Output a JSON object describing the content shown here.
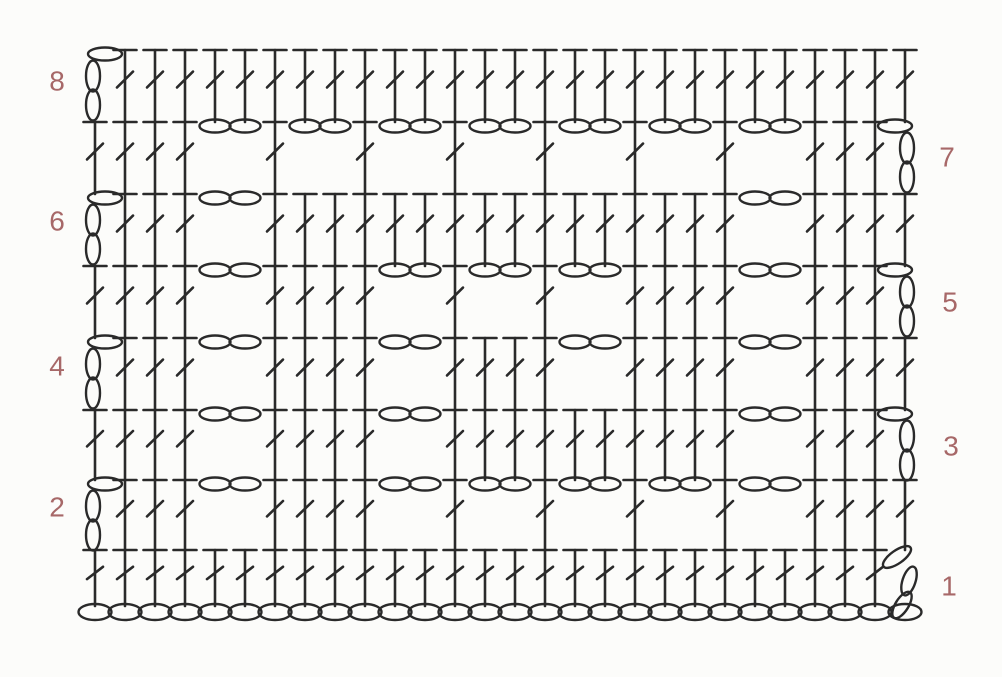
{
  "diagram": {
    "type": "crochet-symbol-chart",
    "background": "#fcfcfa",
    "stitch_color": "#2a2a2a",
    "label_color": "#a76868",
    "columns": 28,
    "geometry": {
      "col_start_x": 95,
      "col_pitch": 30,
      "foundation_y": 612,
      "canvas_w": 1002,
      "canvas_h": 677
    },
    "symbols": {
      "d": "double-crochet",
      "c": "chain",
      "t": "turning-chain-3"
    },
    "foundation": {
      "stitch": "chain",
      "count": 28
    },
    "rows": [
      {
        "number": 1,
        "label": "1",
        "label_side": "right",
        "label_x": 949,
        "label_y": 588,
        "top_y": 550,
        "base_y": 606,
        "turning_chain": {
          "side": "right",
          "style": "tilted"
        },
        "stitches": "dddddddddddddddddddddddddddt"
      },
      {
        "number": 2,
        "label": "2",
        "label_side": "left",
        "label_x": 57,
        "label_y": 509,
        "top_y": 480,
        "base_y": 550,
        "turning_chain": {
          "side": "left",
          "style": "upright"
        },
        "stitches": "tdddccddddccdccdccdccdccdddd"
      },
      {
        "number": 3,
        "label": "3",
        "label_side": "right",
        "label_x": 951,
        "label_y": 448,
        "top_y": 410,
        "base_y": 480,
        "turning_chain": {
          "side": "right",
          "style": "upright"
        },
        "stitches": "ddddccddddccddddddddddccdddt"
      },
      {
        "number": 4,
        "label": "4",
        "label_side": "left",
        "label_x": 57,
        "label_y": 368,
        "top_y": 338,
        "base_y": 410,
        "turning_chain": {
          "side": "left",
          "style": "upright"
        },
        "stitches": "tdddccddddccddddccddddccdddd"
      },
      {
        "number": 5,
        "label": "5",
        "label_side": "right",
        "label_x": 950,
        "label_y": 304,
        "top_y": 266,
        "base_y": 338,
        "turning_chain": {
          "side": "right",
          "style": "upright"
        },
        "stitches": "ddddccddddccdccdccddddccdddt"
      },
      {
        "number": 6,
        "label": "6",
        "label_side": "left",
        "label_x": 57,
        "label_y": 223,
        "top_y": 194,
        "base_y": 266,
        "turning_chain": {
          "side": "left",
          "style": "upright"
        },
        "stitches": "tdddccddddddddddddddddccdddd"
      },
      {
        "number": 7,
        "label": "7",
        "label_side": "right",
        "label_x": 947,
        "label_y": 159,
        "top_y": 122,
        "base_y": 194,
        "turning_chain": {
          "side": "right",
          "style": "upright"
        },
        "stitches": "ddddccdccdccdccdccdccdccdddt"
      },
      {
        "number": 8,
        "label": "8",
        "label_side": "left",
        "label_x": 57,
        "label_y": 83,
        "top_y": 50,
        "base_y": 122,
        "turning_chain": {
          "side": "left",
          "style": "upright"
        },
        "stitches": "tddddddddddddddddddddddddddd"
      }
    ]
  }
}
